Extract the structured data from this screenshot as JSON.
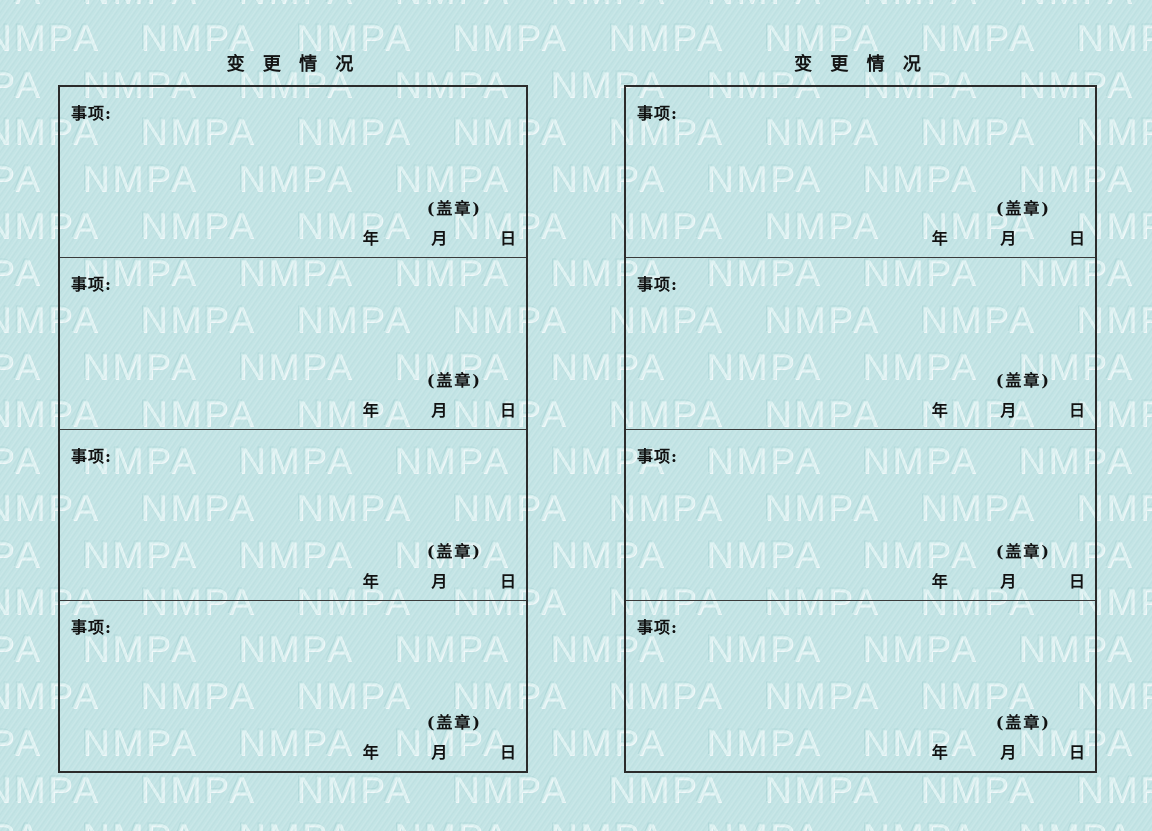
{
  "watermark": {
    "text": "NMPA"
  },
  "colors": {
    "paper": "#c3e4e5",
    "watermark_fill": "#d8f0f0",
    "border": "#2b2b2b",
    "ink": "#111111"
  },
  "labels": {
    "item": "事项:",
    "seal": "(盖章)",
    "year": "年",
    "month": "月",
    "day": "日"
  },
  "pages": [
    {
      "title": "变 更 情 况"
    },
    {
      "title": "变 更 情 况"
    }
  ]
}
